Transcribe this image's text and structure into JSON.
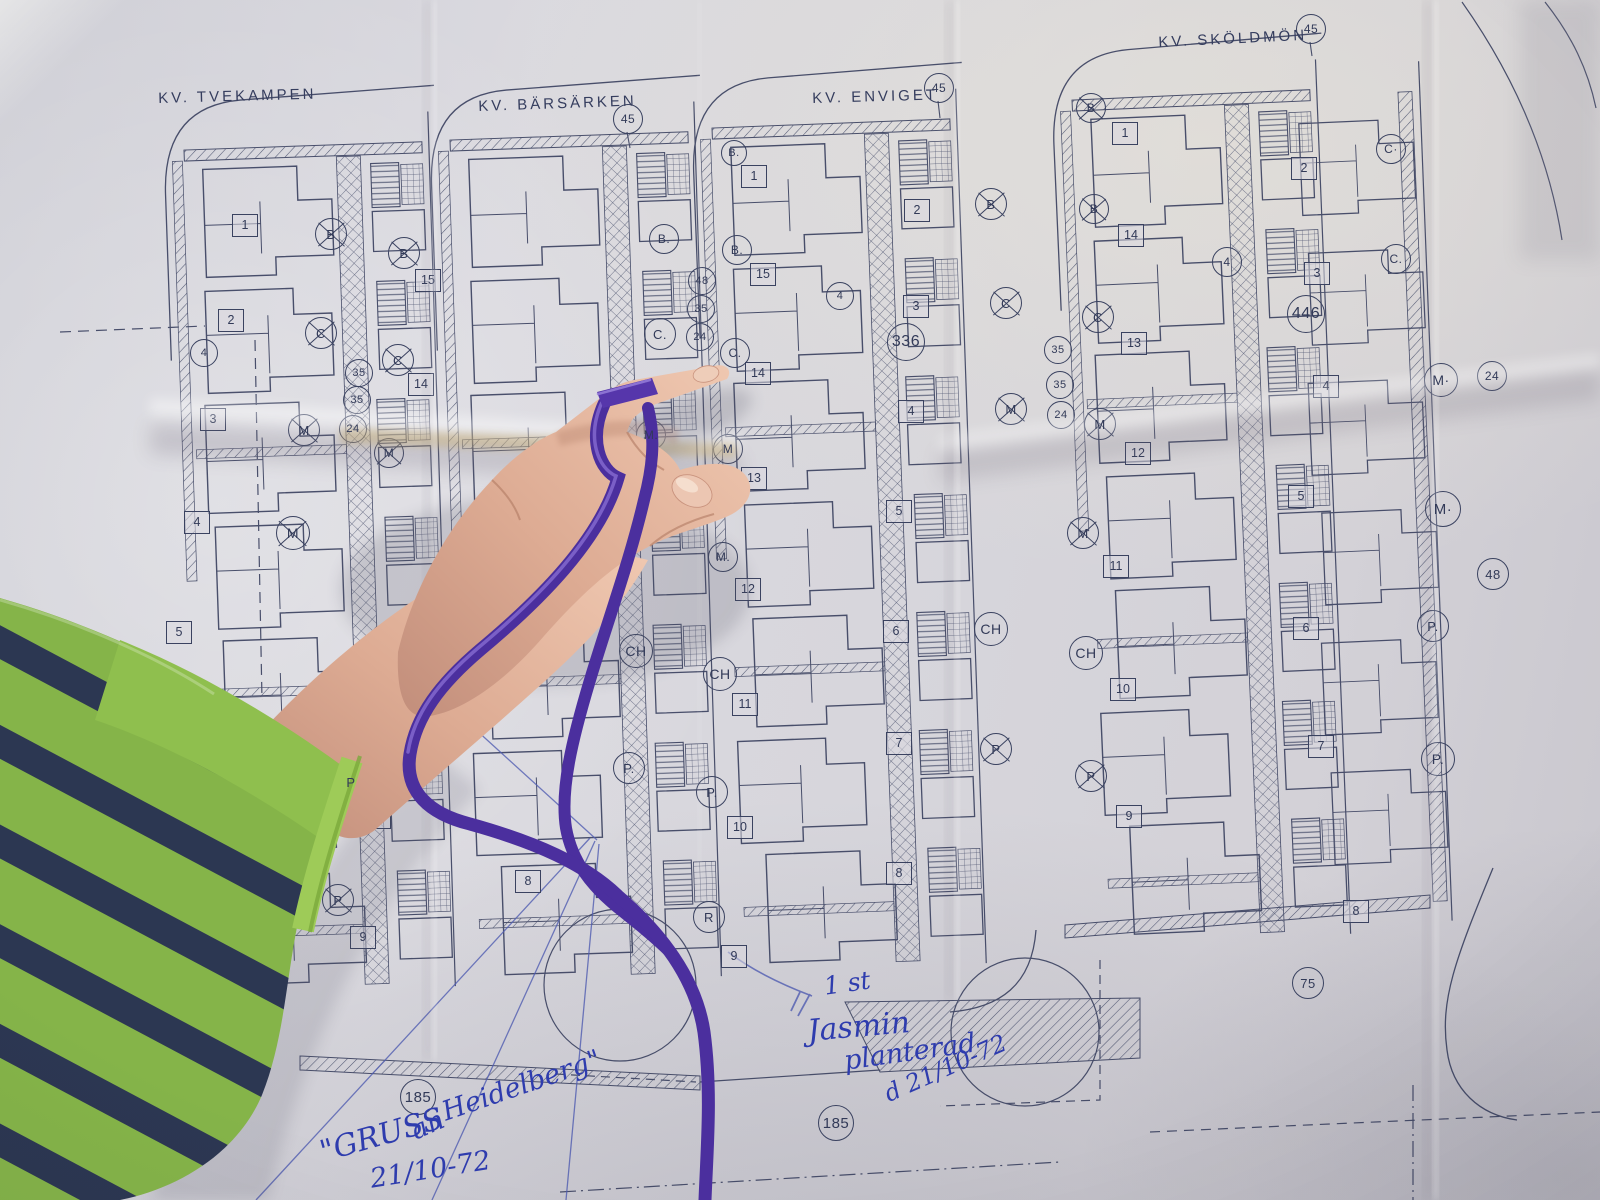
{
  "blocks": [
    {
      "name": "KV. TVEKAMPEN"
    },
    {
      "name": "KV. BÄRSÄRKEN"
    },
    {
      "name": "KV. ENVIGET"
    },
    {
      "name": "KV. SKÖLDMÖN"
    }
  ],
  "notes": {
    "planted_qty": "1 st",
    "planted_l1": "Jasmin",
    "planted_l2": "planterad",
    "planted_date": "d 21/10-72",
    "greeting_l1": "\"GRUSS",
    "greeting_l2": "an",
    "greeting_l3": "Heidelberg\"",
    "greeting_date": "21/10-72"
  },
  "markers": {
    "circles": [
      {
        "t": "B",
        "x": 330,
        "y": 233,
        "r": 15,
        "c": 1
      },
      {
        "t": "B",
        "x": 403,
        "y": 252,
        "r": 15,
        "c": 1
      },
      {
        "t": "C",
        "x": 320,
        "y": 332,
        "r": 15,
        "c": 1
      },
      {
        "t": "4",
        "x": 203,
        "y": 352,
        "r": 13
      },
      {
        "t": "C",
        "x": 397,
        "y": 359,
        "r": 15,
        "c": 1
      },
      {
        "t": "35",
        "x": 358,
        "y": 372,
        "r": 13
      },
      {
        "t": "35",
        "x": 356,
        "y": 399,
        "r": 13
      },
      {
        "t": "24",
        "x": 352,
        "y": 428,
        "r": 13
      },
      {
        "t": "M",
        "x": 303,
        "y": 429,
        "r": 15,
        "c": 1
      },
      {
        "t": "M",
        "x": 388,
        "y": 452,
        "r": 14,
        "c": 1
      },
      {
        "t": "M",
        "x": 292,
        "y": 532,
        "r": 16,
        "c": 1
      },
      {
        "t": "P",
        "x": 350,
        "y": 781,
        "r": 15,
        "c": 1
      },
      {
        "t": "P",
        "x": 337,
        "y": 899,
        "r": 15,
        "c": 1
      },
      {
        "t": "B.",
        "x": 663,
        "y": 238,
        "r": 14
      },
      {
        "t": "B.",
        "x": 736,
        "y": 249,
        "r": 14
      },
      {
        "t": "48",
        "x": 701,
        "y": 280,
        "r": 13
      },
      {
        "t": "35",
        "x": 700,
        "y": 308,
        "r": 13
      },
      {
        "t": "C.",
        "x": 659,
        "y": 333,
        "r": 15
      },
      {
        "t": "24",
        "x": 699,
        "y": 336,
        "r": 13
      },
      {
        "t": "C.",
        "x": 734,
        "y": 352,
        "r": 14
      },
      {
        "t": "4",
        "x": 839,
        "y": 295,
        "r": 13
      },
      {
        "t": "M.",
        "x": 650,
        "y": 434,
        "r": 14
      },
      {
        "t": "M",
        "x": 727,
        "y": 448,
        "r": 14
      },
      {
        "t": "M.",
        "x": 722,
        "y": 556,
        "r": 14
      },
      {
        "t": "CH",
        "x": 635,
        "y": 650,
        "r": 16
      },
      {
        "t": "CH",
        "x": 719,
        "y": 673,
        "r": 16
      },
      {
        "t": "P.",
        "x": 628,
        "y": 767,
        "r": 15
      },
      {
        "t": "P.",
        "x": 711,
        "y": 791,
        "r": 15
      },
      {
        "t": "R",
        "x": 708,
        "y": 916,
        "r": 15
      },
      {
        "t": "185",
        "x": 417,
        "y": 1096,
        "r": 17
      },
      {
        "t": "185",
        "x": 835,
        "y": 1122,
        "r": 17
      },
      {
        "t": "B.",
        "x": 733,
        "y": 152,
        "r": 12
      },
      {
        "t": "336",
        "x": 905,
        "y": 341,
        "r": 18
      },
      {
        "t": "B",
        "x": 990,
        "y": 203,
        "r": 15,
        "c": 1
      },
      {
        "t": "C",
        "x": 1005,
        "y": 302,
        "r": 15,
        "c": 1
      },
      {
        "t": "35",
        "x": 1057,
        "y": 349,
        "r": 13
      },
      {
        "t": "35",
        "x": 1059,
        "y": 384,
        "r": 13
      },
      {
        "t": "M",
        "x": 1010,
        "y": 408,
        "r": 15,
        "c": 1
      },
      {
        "t": "24",
        "x": 1060,
        "y": 414,
        "r": 13
      },
      {
        "t": "M",
        "x": 1099,
        "y": 423,
        "r": 15,
        "c": 1
      },
      {
        "t": "M",
        "x": 1082,
        "y": 532,
        "r": 15,
        "c": 1
      },
      {
        "t": "CH",
        "x": 990,
        "y": 628,
        "r": 16
      },
      {
        "t": "CH",
        "x": 1085,
        "y": 652,
        "r": 16
      },
      {
        "t": "P",
        "x": 995,
        "y": 748,
        "r": 15,
        "c": 1
      },
      {
        "t": "P",
        "x": 1090,
        "y": 775,
        "r": 15,
        "c": 1
      },
      {
        "t": "75",
        "x": 1307,
        "y": 982,
        "r": 15
      },
      {
        "t": "B",
        "x": 1090,
        "y": 107,
        "r": 14,
        "c": 1
      },
      {
        "t": "B",
        "x": 1093,
        "y": 208,
        "r": 14,
        "c": 1
      },
      {
        "t": "4",
        "x": 1226,
        "y": 261,
        "r": 14
      },
      {
        "t": "C",
        "x": 1097,
        "y": 316,
        "r": 15,
        "c": 1
      },
      {
        "t": "446",
        "x": 1305,
        "y": 313,
        "r": 18
      },
      {
        "t": "C·",
        "x": 1390,
        "y": 148,
        "r": 14
      },
      {
        "t": "C.",
        "x": 1395,
        "y": 258,
        "r": 14
      },
      {
        "t": "M·",
        "x": 1440,
        "y": 379,
        "r": 16
      },
      {
        "t": "24",
        "x": 1491,
        "y": 375,
        "r": 14
      },
      {
        "t": "M·",
        "x": 1442,
        "y": 508,
        "r": 17
      },
      {
        "t": "48",
        "x": 1492,
        "y": 573,
        "r": 15
      },
      {
        "t": "P.",
        "x": 1432,
        "y": 625,
        "r": 15
      },
      {
        "t": "P.",
        "x": 1437,
        "y": 758,
        "r": 16
      },
      {
        "t": "45",
        "x": 627,
        "y": 118,
        "r": 14
      },
      {
        "t": "45",
        "x": 938,
        "y": 87,
        "r": 14
      },
      {
        "t": "45",
        "x": 1310,
        "y": 28,
        "r": 14
      }
    ],
    "squares": [
      {
        "t": "1",
        "x": 244,
        "y": 224
      },
      {
        "t": "15",
        "x": 427,
        "y": 279
      },
      {
        "t": "2",
        "x": 230,
        "y": 319
      },
      {
        "t": "14",
        "x": 420,
        "y": 383
      },
      {
        "t": "3",
        "x": 212,
        "y": 418
      },
      {
        "t": "4",
        "x": 196,
        "y": 521
      },
      {
        "t": "5",
        "x": 178,
        "y": 631
      },
      {
        "t": "11",
        "x": 388,
        "y": 701
      },
      {
        "t": "10",
        "x": 377,
        "y": 816
      },
      {
        "t": "9",
        "x": 362,
        "y": 936
      },
      {
        "t": "6",
        "x": 547,
        "y": 647
      },
      {
        "t": "8",
        "x": 527,
        "y": 880
      },
      {
        "t": "15",
        "x": 762,
        "y": 273
      },
      {
        "t": "14",
        "x": 757,
        "y": 372
      },
      {
        "t": "13",
        "x": 753,
        "y": 477
      },
      {
        "t": "12",
        "x": 747,
        "y": 588
      },
      {
        "t": "11",
        "x": 744,
        "y": 703
      },
      {
        "t": "10",
        "x": 739,
        "y": 826
      },
      {
        "t": "9",
        "x": 733,
        "y": 955
      },
      {
        "t": "1",
        "x": 753,
        "y": 175
      },
      {
        "t": "2",
        "x": 916,
        "y": 209
      },
      {
        "t": "3",
        "x": 915,
        "y": 305
      },
      {
        "t": "4",
        "x": 910,
        "y": 410
      },
      {
        "t": "5",
        "x": 898,
        "y": 510
      },
      {
        "t": "6",
        "x": 895,
        "y": 630
      },
      {
        "t": "7",
        "x": 898,
        "y": 742
      },
      {
        "t": "8",
        "x": 898,
        "y": 872
      },
      {
        "t": "13",
        "x": 1133,
        "y": 342
      },
      {
        "t": "12",
        "x": 1137,
        "y": 452
      },
      {
        "t": "1",
        "x": 1124,
        "y": 132
      },
      {
        "t": "2",
        "x": 1303,
        "y": 167
      },
      {
        "t": "14",
        "x": 1130,
        "y": 234
      },
      {
        "t": "3",
        "x": 1316,
        "y": 272
      },
      {
        "t": "4",
        "x": 1325,
        "y": 385
      },
      {
        "t": "5",
        "x": 1300,
        "y": 495
      },
      {
        "t": "11",
        "x": 1115,
        "y": 565
      },
      {
        "t": "6",
        "x": 1305,
        "y": 627
      },
      {
        "t": "10",
        "x": 1122,
        "y": 688
      },
      {
        "t": "7",
        "x": 1320,
        "y": 745
      },
      {
        "t": "9",
        "x": 1128,
        "y": 815
      },
      {
        "t": "8",
        "x": 1355,
        "y": 910
      }
    ]
  }
}
